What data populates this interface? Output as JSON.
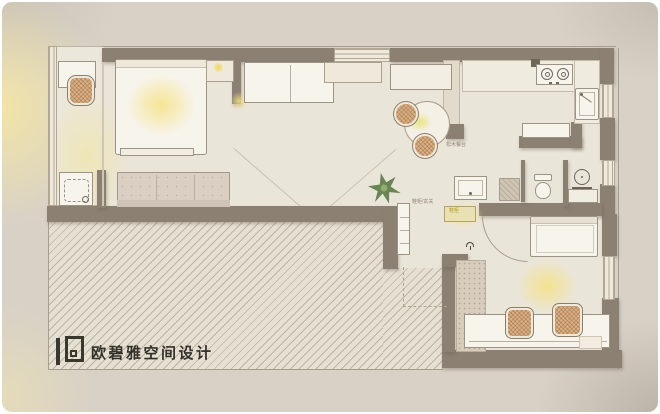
{
  "branding": {
    "logo_text": "欧碧雅空间设计"
  },
  "annotations": {
    "dining_note": "松木餐台",
    "hall_note": "鞋柜/玄关",
    "entry_note": "鞋柜"
  },
  "palette": {
    "canvas": "#ffffff",
    "card_background": "#d8d1c6",
    "floor": "#eae5d9",
    "wall": "#8c8073",
    "furniture_fill": "#f7f4ec",
    "sofa_fill": "#dbcfc4",
    "rattan_chair": "#dfb183",
    "light_glow": "#f6e282",
    "hatch_line": "#968773",
    "plant_green": "#5c7d48",
    "ink": "#33312a"
  },
  "elements": [
    "balcony-window",
    "balcony-desk",
    "rattan-chair",
    "washing-machine",
    "double-bed",
    "nightstand",
    "table-lamp",
    "tv-partition-wall",
    "wall-sofa",
    "sideboard",
    "console-bench",
    "floor-sofa",
    "dining-table",
    "plant",
    "kitchen-counter",
    "stove",
    "kitchen-sink",
    "peninsula-counter",
    "switch-box",
    "bathroom-vanity",
    "shower-tray",
    "toilet",
    "floor-lamp",
    "console-table",
    "shoe-cabinet",
    "entry-cabinet",
    "entry-door-swing",
    "single-bed",
    "study-desk",
    "wardrobe-runner",
    "window",
    "hatched-terrace",
    "logo"
  ]
}
